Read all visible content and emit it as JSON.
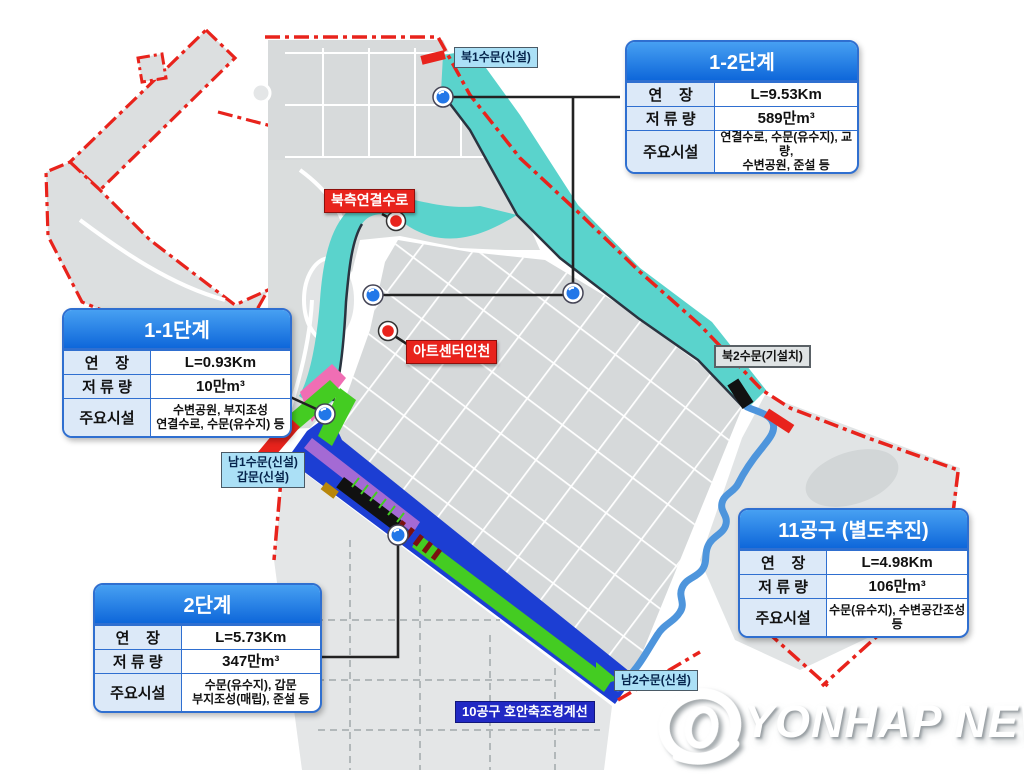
{
  "tables": {
    "phase12": {
      "title": "1-2단계",
      "rows": [
        {
          "label": "연    장",
          "value": "L=9.53Km"
        },
        {
          "label": "저 류 량",
          "value": "589만m³"
        },
        {
          "label": "주요시설",
          "value": "연결수로, 수문(유수지), 교량,\n수변공원, 준설 등"
        }
      ]
    },
    "phase11": {
      "title": "1-1단계",
      "rows": [
        {
          "label": "연    장",
          "value": "L=0.93Km"
        },
        {
          "label": "저 류 량",
          "value": "10만m³"
        },
        {
          "label": "주요시설",
          "value": "수변공원, 부지조성\n연결수로, 수문(유수지) 등"
        }
      ]
    },
    "phase2": {
      "title": "2단계",
      "rows": [
        {
          "label": "연    장",
          "value": "L=5.73Km"
        },
        {
          "label": "저 류 량",
          "value": "347만m³"
        },
        {
          "label": "주요시설",
          "value": "수문(유수지), 갑문\n부지조성(매립), 준설 등"
        }
      ]
    },
    "district11": {
      "title": "11공구 (별도추진)",
      "rows": [
        {
          "label": "연    장",
          "value": "L=4.98Km"
        },
        {
          "label": "저 류 량",
          "value": "106만m³"
        },
        {
          "label": "주요시설",
          "value": "수문(유수지), 수변공간조성 등"
        }
      ]
    }
  },
  "map_labels": {
    "north_gate1": "북1수문(신설)",
    "north_channel": "북측연결수로",
    "art_center": "아트센터인천",
    "north_gate2": "북2수문(기설치)",
    "south_gate1": "남1수문(신설)\n갑문(신설)",
    "south_gate2": "남2수문(신설)",
    "district10_line": "10공구 호안축조경계선"
  },
  "watermark": {
    "text": "YONHAP NEWS"
  },
  "colors": {
    "boundary_red": "#e8231c",
    "water_cyan": "#5ad3cc",
    "canal_blue": "#1c3ed3",
    "route11_blue": "#4e95dc",
    "stripe_green": "#44cc22",
    "stripe_purple": "#a46ad4",
    "stripe_pink": "#f06eb4",
    "table_header_blue": "#1878e8",
    "table_border_blue": "#2f6fd0",
    "tag_light_blue": "#abe0f6",
    "tag_navy": "#2129c4",
    "land_gray": "#d7dadb"
  }
}
